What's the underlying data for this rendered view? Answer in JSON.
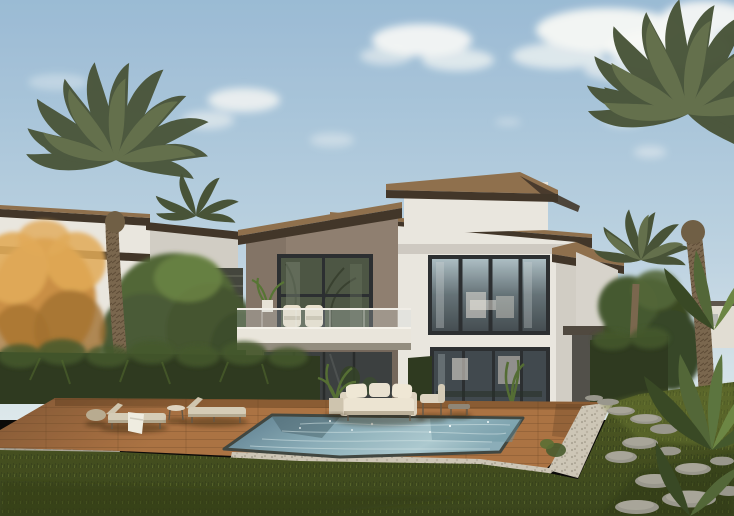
{
  "scene": {
    "title": "Modern villa exterior rendering",
    "description": "Photorealistic architectural render of a two-storey modern villa with dark-taupe and white volumes, brown timber roof fascias, a glass-railed balcony, full-height glazing, a swimming pool with timber deck, sun loungers and an outdoor sofa, flanked by palm trees, an orange autumn tree, dark tropical hedges, a lawn and a stepping-stone path under a partly cloudy blue sky",
    "objects": [
      "sky",
      "clouds",
      "left-neighbour-villa",
      "background-buildings",
      "main-villa",
      "penthouse-volume",
      "dark-wing",
      "balcony",
      "glass-railing",
      "upper-window",
      "lower-window",
      "roof-fascias",
      "left-palm-tree",
      "right-palm-tree",
      "small-palm-tree",
      "autumn-orange-tree",
      "green-trees",
      "tropical-hedge",
      "right-tropical-plants",
      "wood-deck",
      "swimming-pool",
      "pebble-border",
      "sun-lounger",
      "sun-lounger",
      "side-table",
      "outdoor-sofa",
      "armchair",
      "coffee-table",
      "potted-plants",
      "lawn",
      "stepping-stones"
    ]
  },
  "palette": {
    "sky_top": "#96b9d6",
    "sky_mid": "#b6cfe1",
    "sky_horizon": "#dce8ee",
    "cloud": "#f7f9f8",
    "white_wall": "#e9e6e0",
    "white_wall_shade": "#cfccc5",
    "taupe_wall": "#8a7b6d",
    "taupe_dark": "#6e6257",
    "fascia_dark": "#3a2f23",
    "fascia_wood": "#8a6b49",
    "window_frame": "#23272b",
    "glass_dark": "#3d474d",
    "glass_mid": "#5e6d74",
    "glass_sky": "#a9bcc4",
    "balcony_white": "#e9e5dd",
    "under_shadow": "#8f897d",
    "deck": "#a86e3e",
    "deck_dark": "#7c5130",
    "pool_dark": "#527588",
    "pool_mid": "#86abb8",
    "pool_light": "#a9c8d0",
    "coping": "#39403c",
    "pebble": "#cbc5b6",
    "grass": "#49561f",
    "grass_dark": "#323e15",
    "grass_light": "#6a792f",
    "hedge": "#26331a",
    "leaf": "#4c6233",
    "leaf_light": "#66823f",
    "leaf_dark": "#31421f",
    "palm_frond": "#5e6b48",
    "palm_frond_dark": "#404d32",
    "palm_trunk": "#75624a",
    "orange_tree": "#c78b3f",
    "orange_light": "#e0a854",
    "orange_dark": "#9e6b29",
    "stone": "#95948a",
    "stone_light": "#b3b1a4",
    "bg_building": "#e0ddd5",
    "bg_roof": "#564f47",
    "furniture_cream": "#ddd4c2",
    "furniture_white": "#ece4d4",
    "towel_white": "#efede2"
  }
}
